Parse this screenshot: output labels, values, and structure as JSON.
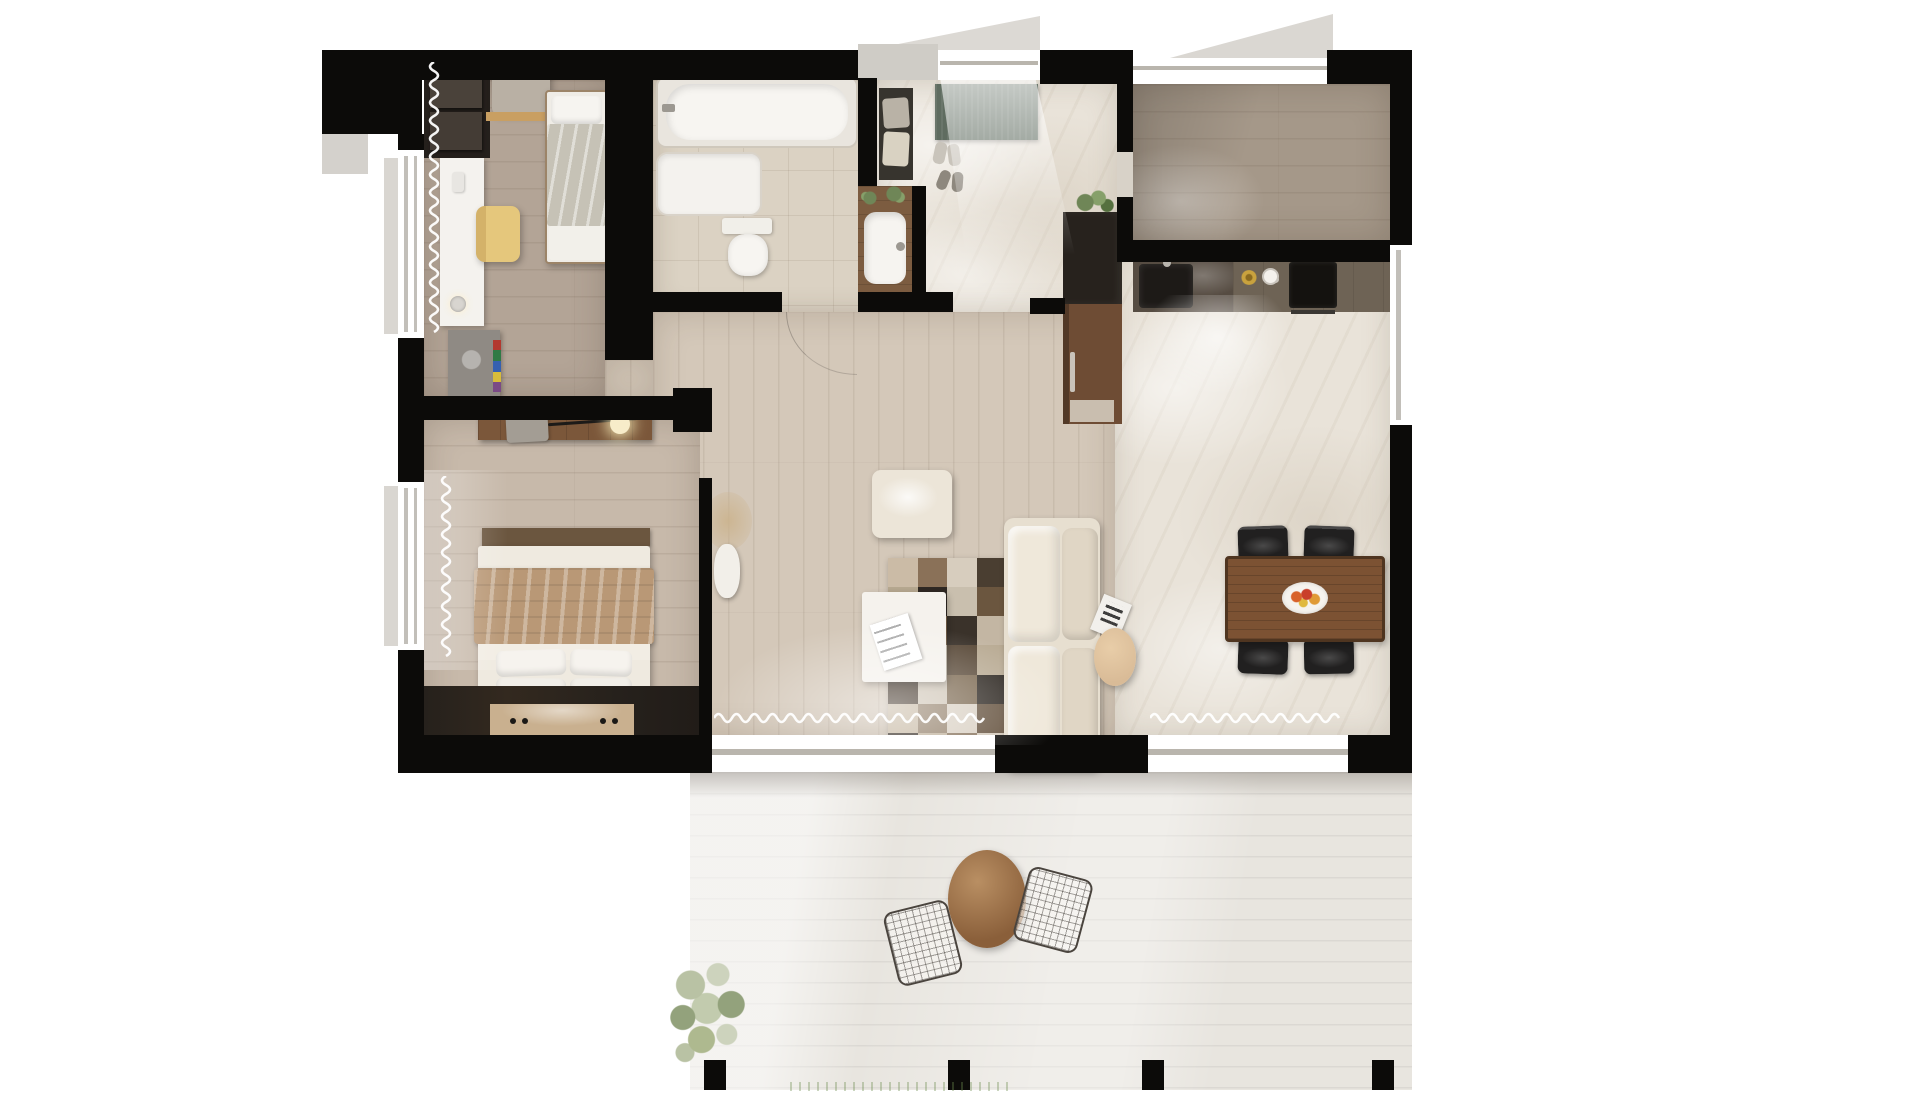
{
  "scene": {
    "type": "3d-rendered-floor-plan",
    "view": "top-down",
    "text_visible": false
  },
  "palette": {
    "wall": "#0c0b09",
    "b1floor": "#b3a496",
    "b2floor": "#c7b9aa",
    "livfloor": "#d4c8b9",
    "trfloor": "#a59889",
    "bath": "#dbd2c3",
    "marble": "#e9e3d9",
    "deck": "#e8e5df",
    "sofa": "#e7dfd0",
    "dining_table": "#7c5233",
    "entry_mat": "#5f6c60",
    "counter_dark": "#564c42",
    "cabinet_dark": "#27221d",
    "door_brown": "#6e4c34",
    "chair_yellow": "#e5c77c",
    "blanket_tan": "#b99876",
    "shelf_wood": "#7b573a",
    "bench_tan": "#c9b08f",
    "pouf_tan": "#d9bb97",
    "plant_green": "#6f8657",
    "terrace_table": "#9c6b44"
  },
  "rug": {
    "cols": 4,
    "rows": 7,
    "colors": [
      "#cbbba6",
      "#8a7158",
      "#d7cdbe",
      "#4a3e31",
      "#b5a78f",
      "#2f2823",
      "#c9bfae",
      "#6b563f",
      "#d8cfc2",
      "#7c654c",
      "#3a322a",
      "#c3b6a3",
      "#8f775c",
      "#d5cbbc",
      "#5a4a39",
      "#b9ab94",
      "#46392d",
      "#cfc5b6",
      "#7b6850",
      "#2c2620",
      "#c7b9a4",
      "#93806a",
      "#d9d0c3",
      "#63503c",
      "#352d25",
      "#bfb19b",
      "#85715a",
      "#d2c8b9"
    ]
  },
  "rooms": {
    "bedroom_1": [
      "wardrobe",
      "armchair",
      "single-bed",
      "desk",
      "desk-lamp",
      "yellow-chair",
      "side-desk-with-books",
      "curtain",
      "window"
    ],
    "bathroom": [
      "bathtub",
      "shower-tray",
      "toilet",
      "vanity-sink",
      "door"
    ],
    "entry_hall": [
      "doormat",
      "bench-with-clothes",
      "shoes",
      "plant",
      "entry-door-light"
    ],
    "study_room": [
      "empty-wood-floor",
      "window",
      "door"
    ],
    "kitchen": [
      "counter",
      "sink",
      "cooktop",
      "coffee-cup",
      "dish",
      "tall-cabinet",
      "pantry-door",
      "plant"
    ],
    "dining": [
      "dining-table",
      "fruit-platter",
      "chairs-x4",
      "window"
    ],
    "living_room": [
      "sofa",
      "round-pouf",
      "square-pouf",
      "patchwork-rug",
      "coffee-table",
      "magazines",
      "vase-dried-flowers",
      "sliding-glass-doors",
      "curtains"
    ],
    "bedroom_2": [
      "wall-shelf",
      "reading-lamp",
      "double-bed",
      "pillows-x4",
      "foot-bench",
      "built-in-wardrobe",
      "curtain",
      "window"
    ],
    "terrace": [
      "deck-planks",
      "round-table",
      "wire-chairs-x2",
      "tree",
      "grass",
      "posts"
    ]
  }
}
